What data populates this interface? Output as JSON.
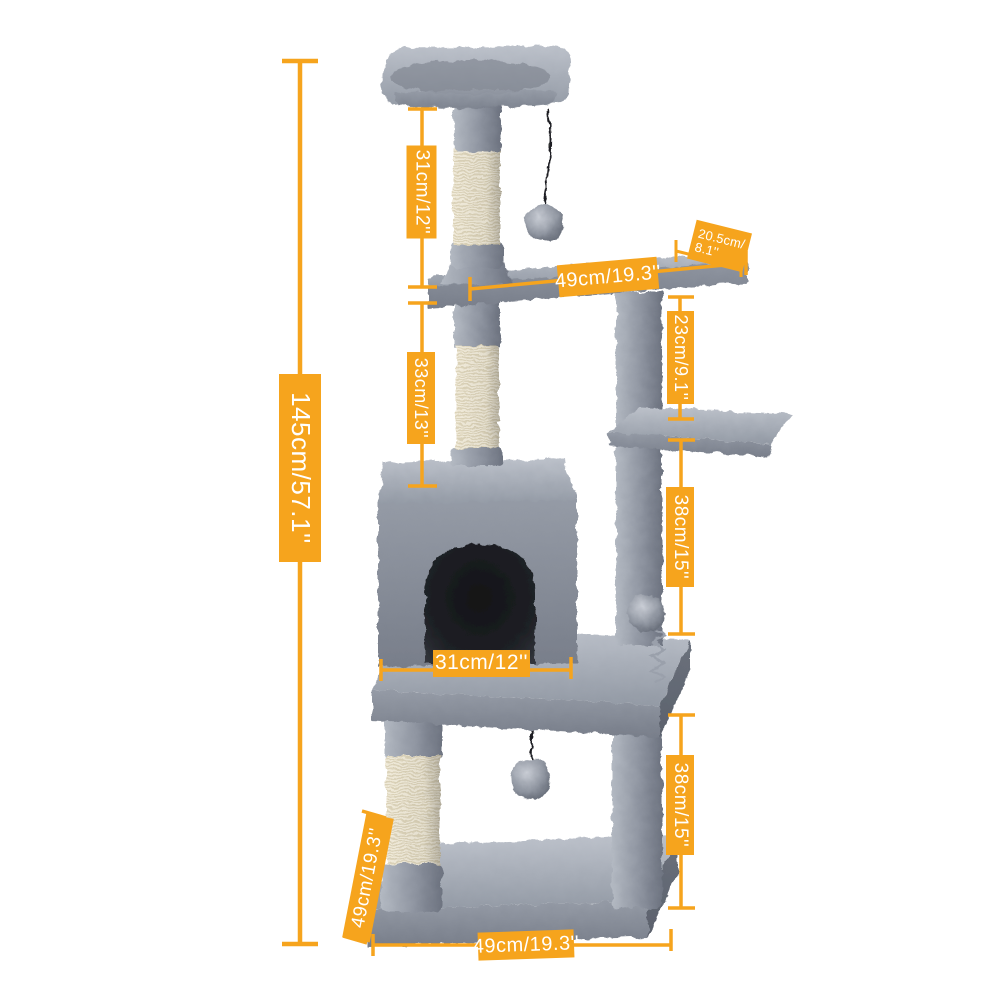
{
  "page": {
    "kind": "product dimension diagram",
    "subject": "cat tree tower with condo, perch, platforms and scratching posts",
    "background": "#ffffff"
  },
  "colors": {
    "accent_orange": "#F6A41D",
    "label_text": "#FFFFFF",
    "plush_grey": "#9298A3",
    "plush_light": "#B9BEC7",
    "plush_dark": "#686E79",
    "sisal": "#F0EAD9",
    "toy_string": "#1C1D20",
    "condo_hole": "#16181C"
  },
  "annotations": {
    "total_height": {
      "label": "145cm/57.1''"
    },
    "top_post": {
      "label": "31cm/12''"
    },
    "upper_shelf_length": {
      "label": "49cm/19.3''"
    },
    "upper_shelf_depth": {
      "lines": [
        "20.5cm/",
        "8.1''"
      ]
    },
    "upper_right_post": {
      "label": "23cm/9.1''"
    },
    "middle_post": {
      "label": "33cm/13''"
    },
    "right_post_upper": {
      "label": "38cm/15''"
    },
    "condo_opening_width": {
      "label": "31cm/12''"
    },
    "right_post_lower": {
      "label": "38cm/15''"
    },
    "base_depth": {
      "label": "49cm/19.3''"
    },
    "base_width": {
      "label": "49cm/19.3''"
    }
  }
}
